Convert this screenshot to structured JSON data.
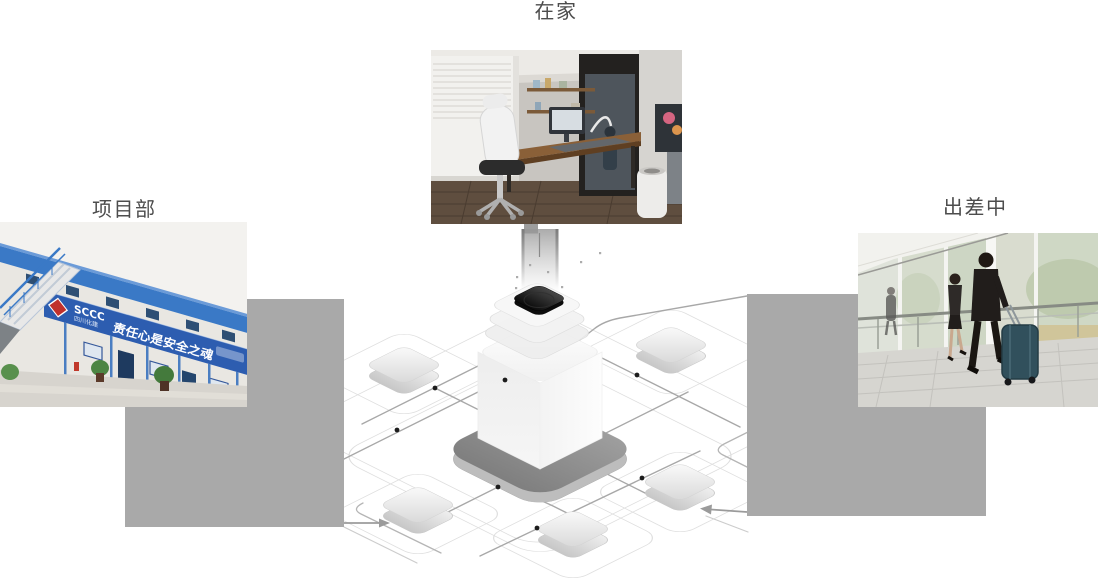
{
  "scenes": {
    "home": {
      "label": "在家"
    },
    "project": {
      "label": "项目部"
    },
    "trip": {
      "label": "出差中"
    }
  },
  "project_banner": {
    "brand": "SCCC",
    "brand_sub": "四川化建",
    "slogan": "责任心是安全之魂"
  },
  "illustration": {
    "name": "isometric-network-hub",
    "satellite_node_count": 5
  },
  "colors": {
    "label_text": "#4d4d4d",
    "placeholder_gray": "#a9a9a9",
    "banner_blue": "#2d5db0",
    "roof_blue": "#3a79c6",
    "platform_gray": "#8d8d8d",
    "network_line": "#a8a8a8",
    "track_line": "#dedede"
  }
}
